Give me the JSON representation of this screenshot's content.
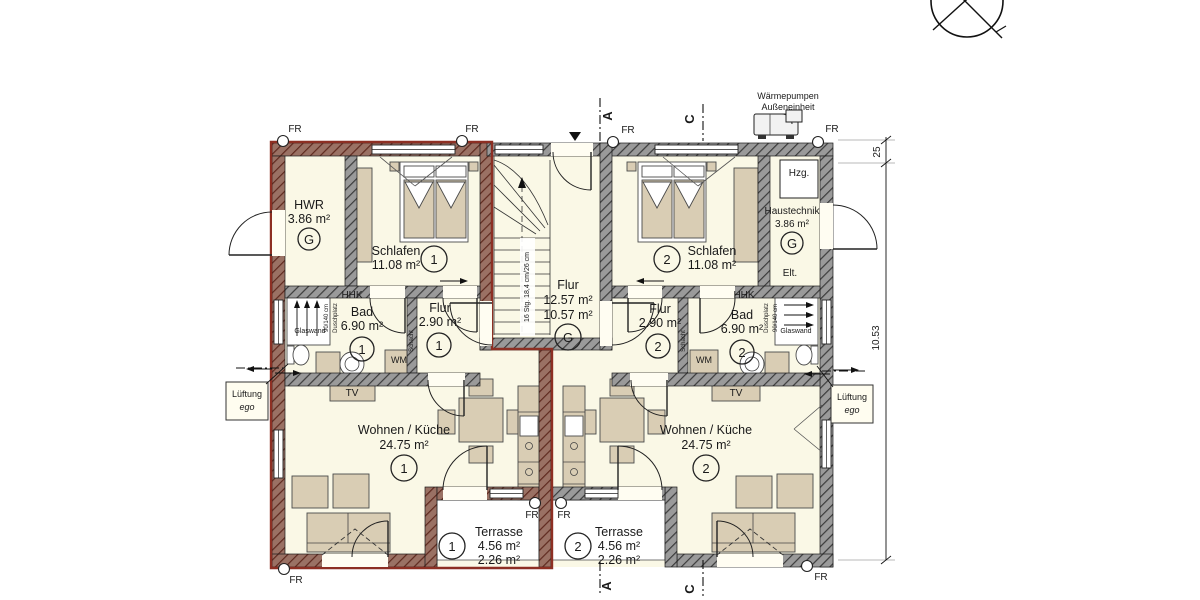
{
  "colors": {
    "room_fill": "#faf8e6",
    "wall_gray": "#9a9a9a",
    "wall_red_tint": "#9a7164",
    "unit1_outline": "#8d2f23",
    "furniture": "#d9cdb4"
  },
  "annotations": {
    "fr": "FR",
    "section_a": "A",
    "section_b": "B",
    "section_c": "C",
    "lueftung1": "Lüftung",
    "lueftung2": "ego",
    "heatpump1": "Wärmepumpen",
    "heatpump2": "Außeneinheit",
    "dim_wall": "25",
    "dim_total": "10.53",
    "stair_note": "16 Stg. 18,4 cm/26 cm",
    "schacht": "Schacht"
  },
  "shared_flur": {
    "name": "Flur",
    "area1": "12.57 m²",
    "area2": "10.57 m²",
    "badge": "G"
  },
  "unit1": {
    "badge": "1",
    "hwr": {
      "name": "HWR",
      "area": "3.86 m²",
      "badge": "G"
    },
    "schlafen": {
      "name": "Schlafen",
      "area": "11.08 m²"
    },
    "bad": {
      "name": "Bad",
      "area": "6.90 m²"
    },
    "flur": {
      "name": "Flur",
      "area": "2.90 m²"
    },
    "wohnen": {
      "name": "Wohnen / Küche",
      "area": "24.75 m²"
    },
    "terrasse": {
      "name": "Terrasse",
      "area1": "4.56 m²",
      "area2": "2.26 m²"
    },
    "hhk": "HHK",
    "wm": "WM",
    "tv": "TV",
    "glaswand": "Glaswand",
    "dusch1": "90/140 cm",
    "dusch2": "Duschplatz"
  },
  "unit2": {
    "badge": "2",
    "haustechnik": {
      "name": "Haustechnik",
      "area": "3.86 m²",
      "badge": "G",
      "hzg": "Hzg.",
      "elt": "Elt."
    },
    "schlafen": {
      "name": "Schlafen",
      "area": "11.08 m²"
    },
    "bad": {
      "name": "Bad",
      "area": "6.90 m²"
    },
    "flur": {
      "name": "Flur",
      "area": "2.90 m²"
    },
    "wohnen": {
      "name": "Wohnen / Küche",
      "area": "24.75 m²"
    },
    "terrasse": {
      "name": "Terrasse",
      "area1": "4.56 m²",
      "area2": "2.26 m²"
    },
    "hhk": "HHK",
    "wm": "WM",
    "tv": "TV",
    "glaswand": "Glaswand",
    "dusch1": "Duschplatz",
    "dusch2": "90/140 cm"
  }
}
